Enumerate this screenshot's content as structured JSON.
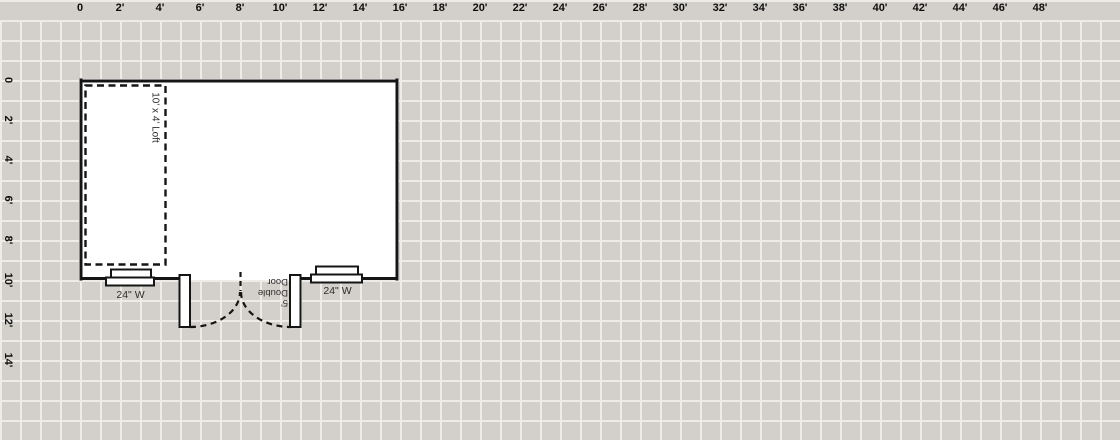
{
  "canvas": {
    "background_color": "#d3d0cb",
    "grid_line_color": "#edece9",
    "wall_color": "#151515",
    "interior_color": "#ffffff",
    "annotation_text_color": "#2e2e2e"
  },
  "rulers": {
    "top": {
      "labels": [
        "0",
        "2'",
        "4'",
        "6'",
        "8'",
        "10'",
        "12'",
        "14'",
        "16'",
        "18'",
        "20'",
        "22'",
        "24'",
        "26'",
        "28'",
        "30'",
        "32'",
        "34'",
        "36'",
        "38'",
        "40'",
        "42'",
        "44'",
        "46'",
        "48'"
      ]
    },
    "left": {
      "labels": [
        "0",
        "2'",
        "4'",
        "6'",
        "8'",
        "10'",
        "12'",
        "14'"
      ]
    }
  },
  "plan": {
    "loft": {
      "label": "10' x 4' Loft"
    },
    "door": {
      "label": "5'\nDouble\nDoor"
    },
    "windows": [
      {
        "label": "24\" W"
      },
      {
        "label": "24\" W"
      }
    ]
  }
}
